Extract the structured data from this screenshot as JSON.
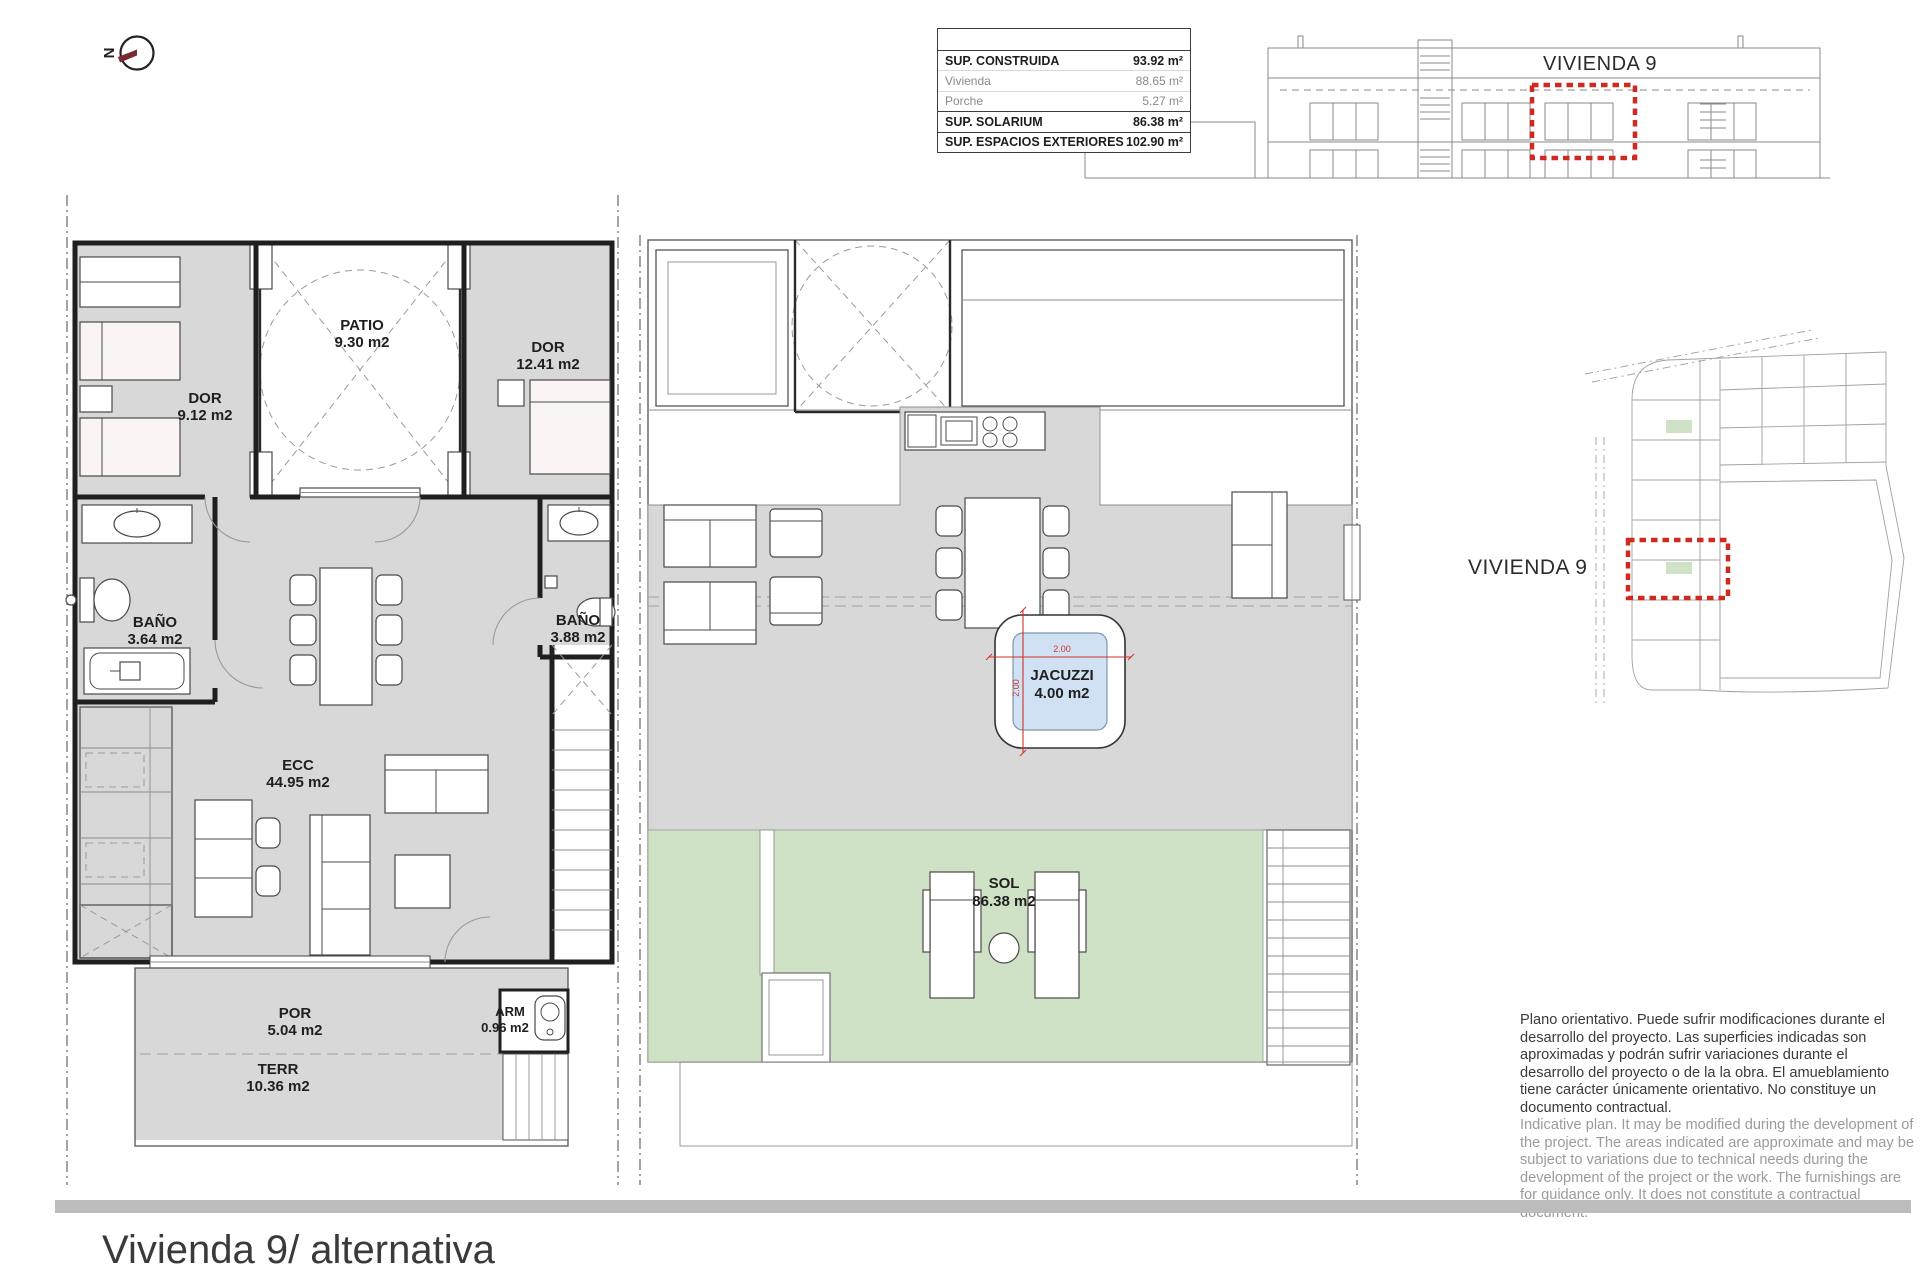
{
  "title": "Vivienda 9/ alternativa",
  "north_label": "N",
  "areas_table": {
    "rows": [
      {
        "label": "SUP. CONSTRUIDA",
        "value": "93.92 m²"
      },
      {
        "label": "Vivienda",
        "value": "88.65 m²"
      },
      {
        "label": "Porche",
        "value": "5.27 m²"
      },
      {
        "label": "SUP. SOLARIUM",
        "value": "86.38 m²"
      },
      {
        "label": "SUP. ESPACIOS EXTERIORES",
        "value": "102.90 m²"
      }
    ]
  },
  "elevation_label": "VIVIENDA 9",
  "site_plan_label": "VIVIENDA 9",
  "ground_floor": {
    "dor1": {
      "name": "DOR",
      "area": "9.12 m2"
    },
    "patio": {
      "name": "PATIO",
      "area": "9.30 m2"
    },
    "dor2": {
      "name": "DOR",
      "area": "12.41 m2"
    },
    "bano1": {
      "name": "BAÑO",
      "area": "3.64 m2"
    },
    "bano2": {
      "name": "BAÑO",
      "area": "3.88 m2"
    },
    "ecc": {
      "name": "ECC",
      "area": "44.95 m2"
    },
    "por": {
      "name": "POR",
      "area": "5.04 m2"
    },
    "terr": {
      "name": "TERR",
      "area": "10.36 m2"
    },
    "arm": {
      "name": "ARM",
      "area": "0.96 m2"
    }
  },
  "solarium": {
    "jacuzzi": {
      "name": "JACUZZI",
      "area": "4.00 m2",
      "width_dim": "2.00",
      "height_dim": "2.00"
    },
    "sol": {
      "name": "SOL",
      "area": "86.38 m2"
    }
  },
  "disclaimer_es": "Plano orientativo. Puede sufrir modificaciones durante el desarrollo del proyecto. Las superficies indicadas son aproximadas y podrán sufrir variaciones durante el desarrollo del proyecto o de la la obra. El amueblamiento tiene carácter únicamente orientativo. No constituye un documento contractual.",
  "disclaimer_en": "Indicative plan. It may be modified during the development of the project. The areas indicated are approximate and may be subject to variations due to technical needs during the development of the project or the work. The furnishings are for guidance only. It does not constitute a contractual document.",
  "colors": {
    "room_gray": "#d8d8d8",
    "sol_green": "#cfe2c5",
    "jacuzzi_blue": "#cfe1f2",
    "highlight_red": "#cf2a20",
    "bottom_bar_gray": "#bcbcbc",
    "north_needle": "#7a2a33"
  }
}
